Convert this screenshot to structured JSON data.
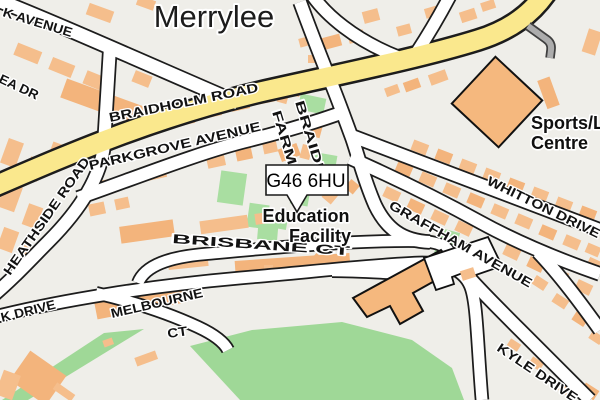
{
  "map": {
    "place_title": "Merrylee",
    "postcode_marker": {
      "text": "G46 6HU"
    },
    "poi_labels": {
      "education_line1": "Education",
      "education_line2": "Facility",
      "sports_line1": "Sports/L",
      "sports_line2": "Centre"
    },
    "road_labels": {
      "avenue_topleft": "K AVENUE",
      "ea_dr": "EA DR",
      "braidholm": "BRAIDHOLM ROAD",
      "parkgrove": "PARKGROVE AVENUE",
      "braidbar_line1": "BRAIDB",
      "braidbar_line2": "FARM R",
      "heathside": "HEATHSIDE ROAD",
      "k_drive": "K DRIVE",
      "melbourne_line1": "MELBOURNE",
      "melbourne_line2": "CT",
      "brisbane": "BRISBANE CT",
      "graffham": "GRAFFHAM AVENUE",
      "whitton": "WHITTON DRIVE",
      "kyle": "KYLE DRIVE"
    },
    "colors": {
      "background": "#EFEEE9",
      "building": "#F5BE8C",
      "building_dark": "#F3B47C",
      "road_fill": "#FFFFFF",
      "road_casing": "#1C1C1C",
      "primary_road": "#FAE88D",
      "green_area": "#9FD897",
      "green_patch": "#A9DEA1",
      "service_road": "#ACACAC",
      "marker_fill": "#FFFFFF",
      "marker_border": "#1A1A1A"
    }
  }
}
